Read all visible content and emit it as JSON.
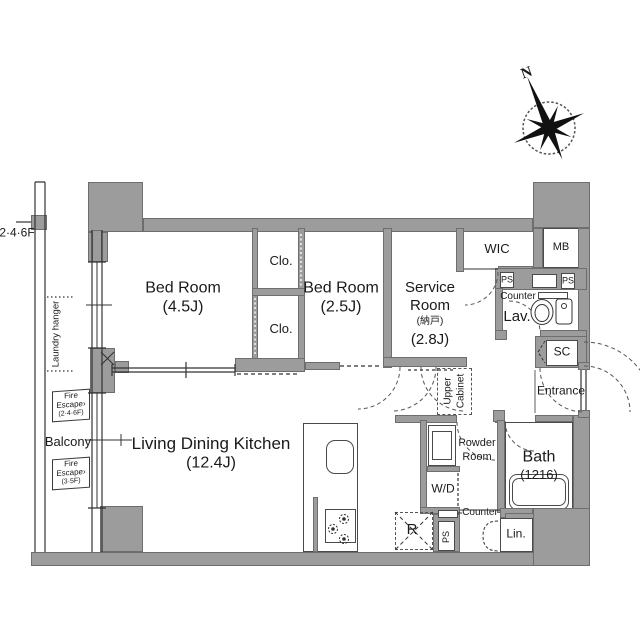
{
  "title": "Apartment floor plan 1LDK+S",
  "colors": {
    "wall": "#9c9c9c",
    "wall_border": "#6e6e6e",
    "line": "#333333",
    "background": "#ffffff"
  },
  "labels": {
    "floor": "2·4·6F",
    "compass_north": "N",
    "bedroom1_name": "Bed Room",
    "bedroom1_size": "(4.5J)",
    "bedroom2_name": "Bed Room",
    "bedroom2_size": "(2.5J)",
    "clo1": "Clo.",
    "clo2": "Clo.",
    "service_1": "Service",
    "service_2": "Room",
    "service_jp": "(納戸)",
    "service_size": "(2.8J)",
    "ldk_name": "Living Dining Kitchen",
    "ldk_size": "(12.4J)",
    "wic": "WIC",
    "mb": "MB",
    "ps_a": "PS",
    "ps_b": "PS",
    "ps_c": "PS",
    "counter_top": "Counter",
    "lav": "Lav.",
    "sc": "SC",
    "entrance": "Entrance",
    "bath": "Bath",
    "bath_size": "(1216)",
    "powder_1": "Powder",
    "powder_2": "Room",
    "wd": "W/D",
    "counter_bottom": "Counter",
    "fridge": "R",
    "lin": "Lin.",
    "upper_cabinet_1": "Upper",
    "upper_cabinet_2": "Cabinet",
    "balcony": "Balcony",
    "laundry": "Laundry hanger",
    "fire1_1": "Fire",
    "fire1_2": "Escape›",
    "fire1_3": "(2·4·6F)",
    "fire2_1": "Fire",
    "fire2_2": "Escape›",
    "fire2_3": "(3·5F)"
  }
}
